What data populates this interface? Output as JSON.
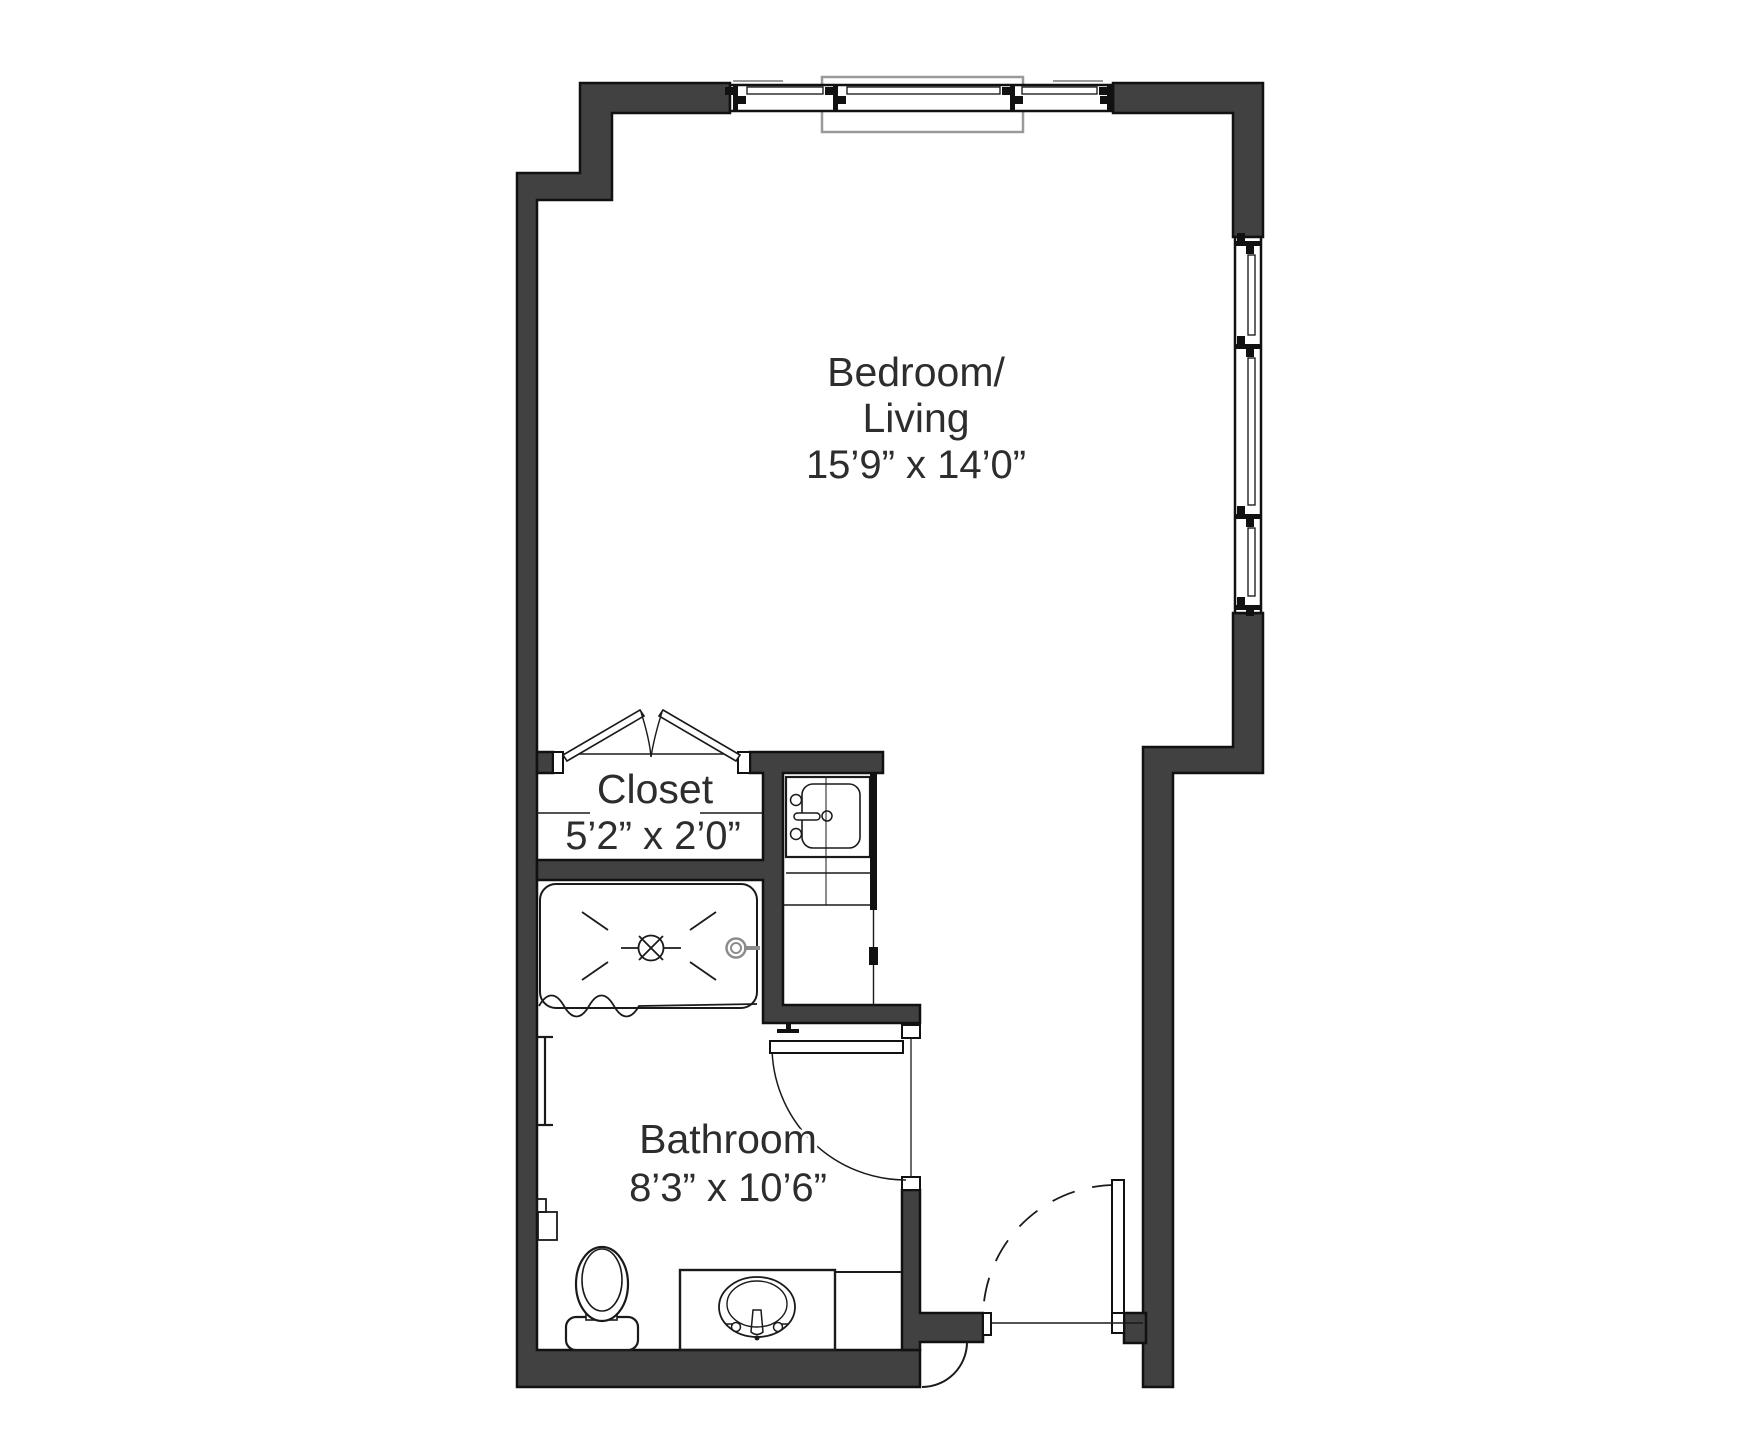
{
  "floorplan": {
    "type": "studio-apartment-floor-plan",
    "rooms": {
      "bedroom": {
        "line1": "Bedroom/",
        "line2": "Living",
        "dims": "15’9” x 14’0”"
      },
      "closet": {
        "label": "Closet",
        "dims": "5’2” x 2’0”"
      },
      "bathroom": {
        "label": "Bathroom",
        "dims": "8’3” x 10’6”"
      }
    },
    "fixtures": [
      "shower-pan",
      "shower-drain",
      "shower-head",
      "shower-curtain",
      "utility-sink",
      "kitchenette-counter",
      "toilet",
      "vanity-sink",
      "grab-bar",
      "toilet-paper-holder",
      "bifold-closet-doors",
      "bathroom-door",
      "entry-door",
      "top-window-band",
      "right-window-band"
    ],
    "colors": {
      "wall": "#414141",
      "wall_outline": "#111111",
      "line": "#1a1a1a",
      "text": "#2d2d2d",
      "window_surround": "#9a9a9a",
      "background": "#ffffff"
    }
  }
}
